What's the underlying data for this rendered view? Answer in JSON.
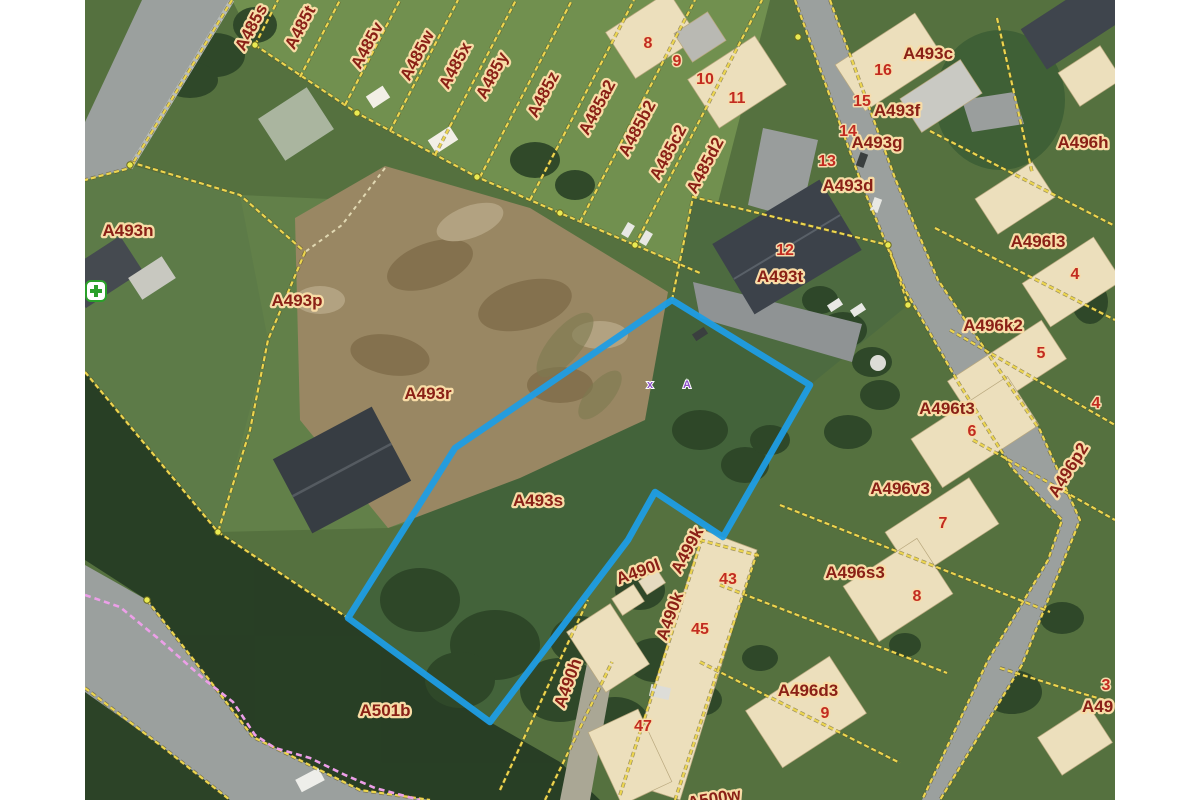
{
  "map": {
    "type": "cadastral-aerial-view",
    "highlighted_parcel": "A493s",
    "colors": {
      "highlight_outline": "#1f9de4",
      "parcel_line": "#ecd54f",
      "parcel_label_text": "#8a2016",
      "parcel_label_halo": "#f8dca6",
      "house_number_text": "#c22b20",
      "survey_mark": "#8d4fc9",
      "utility_line_pink": "#ec9fe8"
    },
    "highlight_polygon_points": "672,300 810,385 723,537 655,492 628,540 490,722 348,618 455,448",
    "parcel_labels": [
      {
        "text": "A485s",
        "x": 256,
        "y": 30,
        "rot": -62
      },
      {
        "text": "A485t",
        "x": 305,
        "y": 30,
        "rot": -62
      },
      {
        "text": "A485v",
        "x": 372,
        "y": 48,
        "rot": -62
      },
      {
        "text": "A485w",
        "x": 422,
        "y": 58,
        "rot": -62
      },
      {
        "text": "A485x",
        "x": 460,
        "y": 68,
        "rot": -62
      },
      {
        "text": "A485y",
        "x": 497,
        "y": 78,
        "rot": -62
      },
      {
        "text": "A485z",
        "x": 548,
        "y": 97,
        "rot": -62
      },
      {
        "text": "A485a2",
        "x": 602,
        "y": 110,
        "rot": -62
      },
      {
        "text": "A485b2",
        "x": 642,
        "y": 131,
        "rot": -62
      },
      {
        "text": "A485c2",
        "x": 673,
        "y": 155,
        "rot": -62
      },
      {
        "text": "A485d2",
        "x": 710,
        "y": 168,
        "rot": -62
      },
      {
        "text": "A493n",
        "x": 128,
        "y": 236,
        "rot": 0
      },
      {
        "text": "A493p",
        "x": 297,
        "y": 306,
        "rot": 0
      },
      {
        "text": "A493r",
        "x": 428,
        "y": 399,
        "rot": 0
      },
      {
        "text": "A493s",
        "x": 538,
        "y": 506,
        "rot": 0
      },
      {
        "text": "A493t",
        "x": 780,
        "y": 282,
        "rot": 0
      },
      {
        "text": "A493c",
        "x": 928,
        "y": 59,
        "rot": 0
      },
      {
        "text": "A493f",
        "x": 897,
        "y": 116,
        "rot": 0
      },
      {
        "text": "A493g",
        "x": 877,
        "y": 148,
        "rot": 0
      },
      {
        "text": "A493d",
        "x": 848,
        "y": 191,
        "rot": 0
      },
      {
        "text": "A496h",
        "x": 1083,
        "y": 148,
        "rot": 0
      },
      {
        "text": "A496l3",
        "x": 1038,
        "y": 247,
        "rot": 0
      },
      {
        "text": "A496k2",
        "x": 993,
        "y": 331,
        "rot": 0
      },
      {
        "text": "A496t3",
        "x": 947,
        "y": 414,
        "rot": 0
      },
      {
        "text": "A496v3",
        "x": 900,
        "y": 494,
        "rot": 0
      },
      {
        "text": "A496s3",
        "x": 855,
        "y": 578,
        "rot": 0
      },
      {
        "text": "A496d3",
        "x": 808,
        "y": 696,
        "rot": 0
      },
      {
        "text": "A496p2",
        "x": 1073,
        "y": 473,
        "rot": -58
      },
      {
        "text": "A499k",
        "x": 692,
        "y": 553,
        "rot": -62
      },
      {
        "text": "A490l",
        "x": 640,
        "y": 577,
        "rot": -20
      },
      {
        "text": "A490k",
        "x": 675,
        "y": 618,
        "rot": -70
      },
      {
        "text": "A490h",
        "x": 573,
        "y": 685,
        "rot": -70
      },
      {
        "text": "A501b",
        "x": 385,
        "y": 716,
        "rot": 0
      },
      {
        "text": "A500w",
        "x": 715,
        "y": 804,
        "rot": -10
      },
      {
        "text": "A49",
        "x": 1082,
        "y": 712,
        "rot": 0,
        "anchor": "start"
      }
    ],
    "house_numbers": [
      {
        "text": "8",
        "x": 648,
        "y": 48
      },
      {
        "text": "9",
        "x": 677,
        "y": 66
      },
      {
        "text": "10",
        "x": 705,
        "y": 84
      },
      {
        "text": "11",
        "x": 737,
        "y": 103
      },
      {
        "text": "16",
        "x": 883,
        "y": 75
      },
      {
        "text": "15",
        "x": 862,
        "y": 106
      },
      {
        "text": "14",
        "x": 848,
        "y": 136
      },
      {
        "text": "13",
        "x": 827,
        "y": 166
      },
      {
        "text": "12",
        "x": 785,
        "y": 255
      },
      {
        "text": "4",
        "x": 1075,
        "y": 279
      },
      {
        "text": "5",
        "x": 1041,
        "y": 358
      },
      {
        "text": "6",
        "x": 972,
        "y": 436
      },
      {
        "text": "7",
        "x": 943,
        "y": 528
      },
      {
        "text": "8",
        "x": 917,
        "y": 601
      },
      {
        "text": "9",
        "x": 825,
        "y": 718
      },
      {
        "text": "43",
        "x": 728,
        "y": 584
      },
      {
        "text": "45",
        "x": 700,
        "y": 634
      },
      {
        "text": "47",
        "x": 643,
        "y": 731
      },
      {
        "text": "4",
        "x": 1096,
        "y": 408
      },
      {
        "text": "3",
        "x": 1106,
        "y": 690
      }
    ],
    "survey_marks": [
      {
        "text": "x",
        "x": 650,
        "y": 388
      },
      {
        "text": "A",
        "x": 687,
        "y": 388
      }
    ],
    "pharmacy_icon": {
      "x": 86,
      "y": 281
    }
  }
}
